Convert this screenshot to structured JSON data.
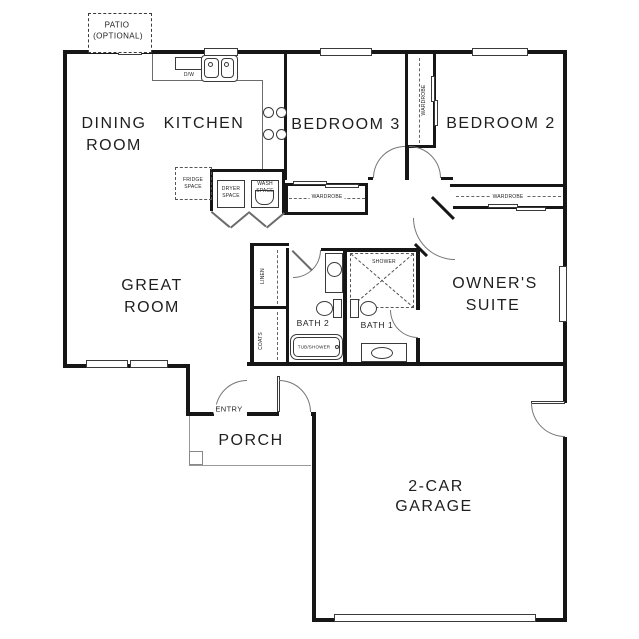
{
  "patio": {
    "line1": "PATIO",
    "line2": "(OPTIONAL)"
  },
  "rooms": {
    "dining1": "DINING",
    "dining2": "ROOM",
    "kitchen": "KITCHEN",
    "bedroom3": "BEDROOM 3",
    "bedroom2": "BEDROOM 2",
    "great1": "GREAT",
    "great2": "ROOM",
    "owners1": "OWNER'S",
    "owners2": "SUITE",
    "bath1": "BATH 1",
    "bath2": "BATH 2",
    "porch": "PORCH",
    "garage1": "2-CAR",
    "garage2": "GARAGE",
    "entry": "ENTRY"
  },
  "closets": {
    "linen": "LINEN",
    "coats": "COATS",
    "wardrobe": "WARDROBE"
  },
  "fixtures": {
    "dw": "D/W",
    "fridge1": "FRIDGE",
    "fridge2": "SPACE",
    "dryer1": "DRYER",
    "dryer2": "SPACE",
    "wash1": "WASH",
    "wash2": "SPACE",
    "shower": "SHOWER",
    "tub": "TUB/SHOWER"
  },
  "colors": {
    "wall": "#161616",
    "line": "#555555",
    "text": "#1f1f1f",
    "bg": "#ffffff"
  }
}
